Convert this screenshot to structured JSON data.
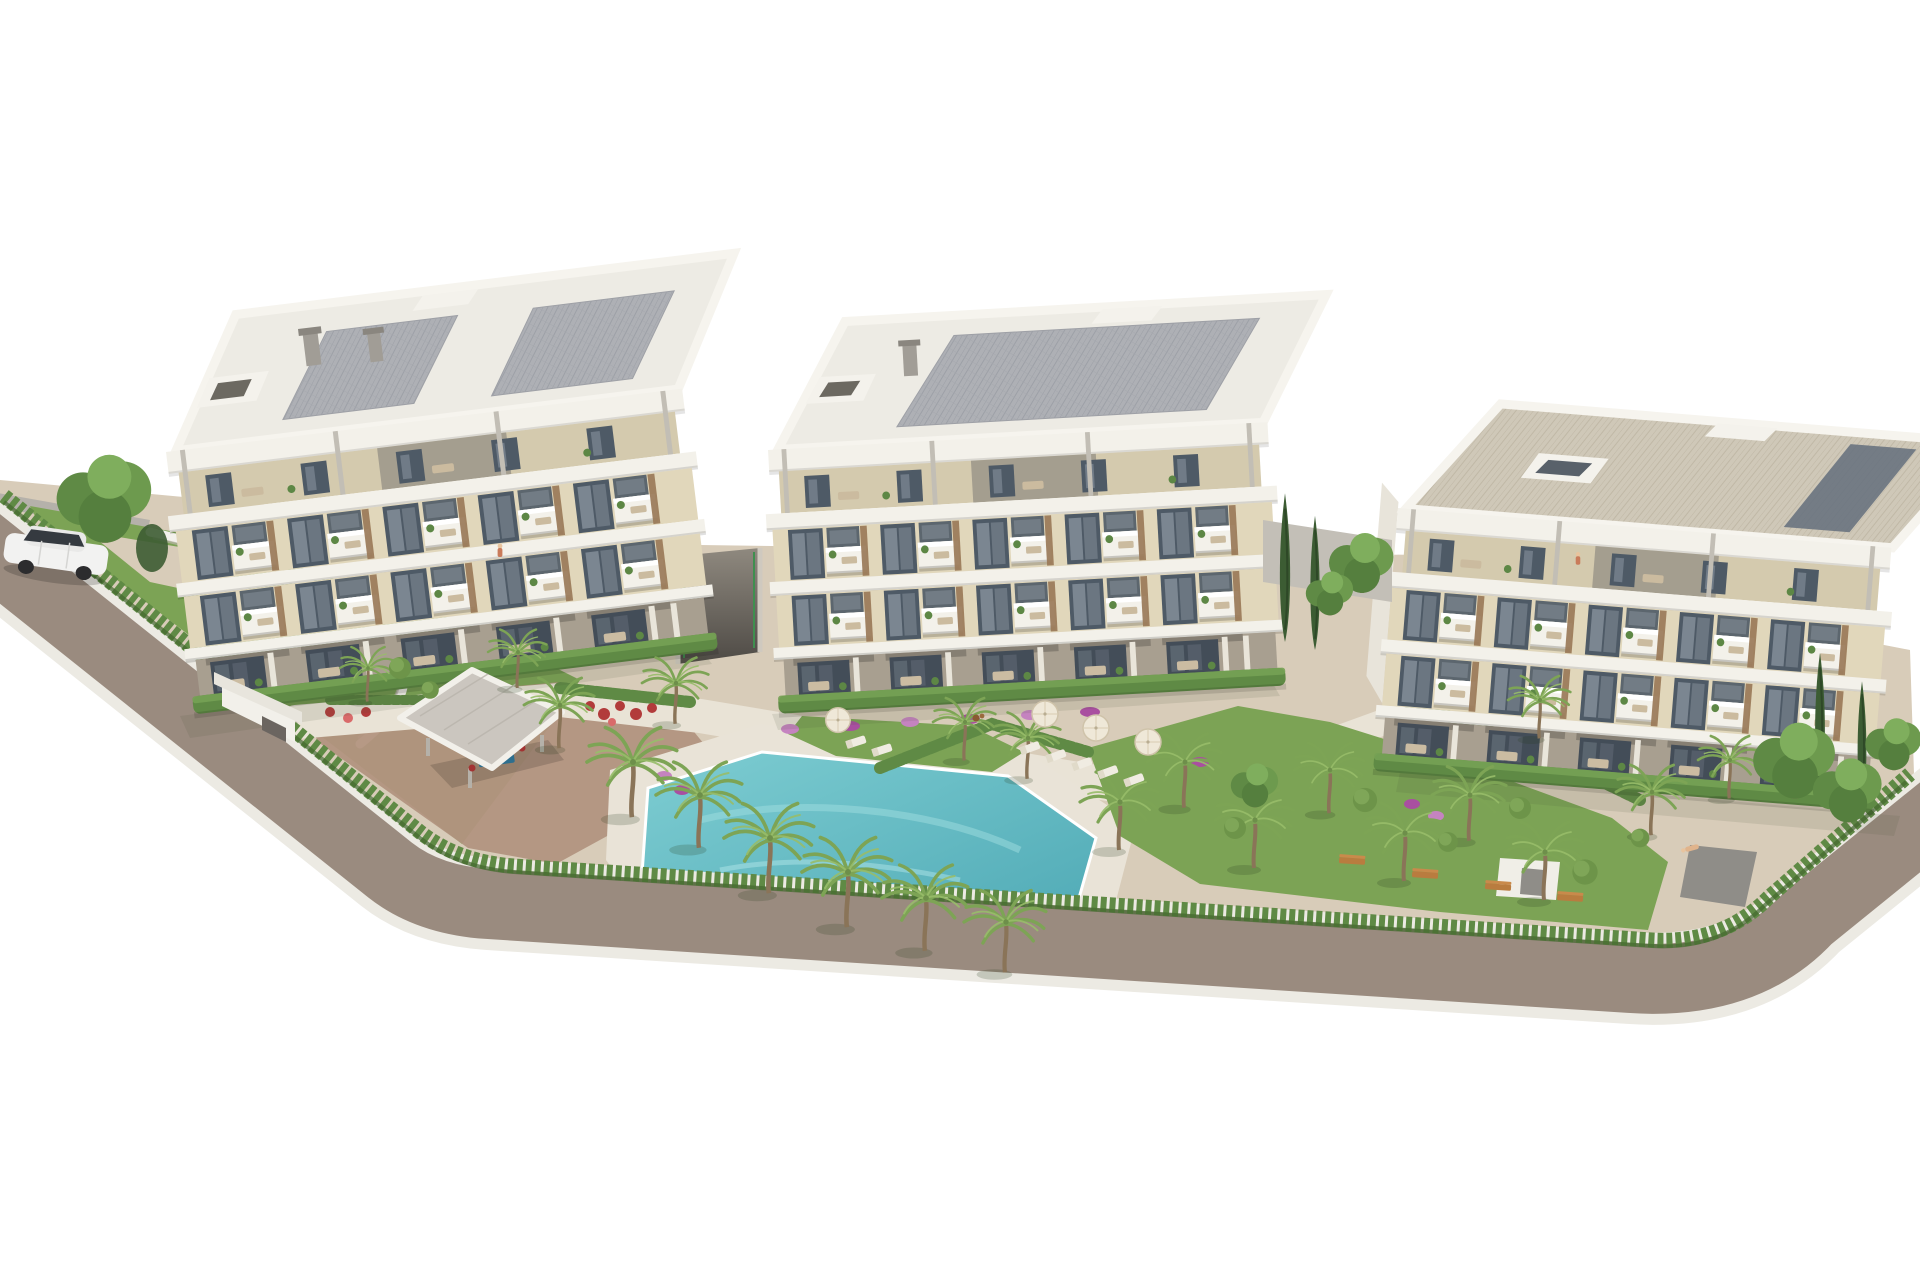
{
  "scene": {
    "alt": "Aerial 3D architectural rendering of a residential complex: three modern cream-and-white apartment buildings with flat solar-panel roofs and plant-filled balconies, communal landscaped gardens with palm trees, hedges, flower beds, a turquoise swimming pool, sun loungers with parasols, a grey-roofed pavilion, an entrance gate, and an L-shaped road with a parked white car, on a plain white background.",
    "elements": {
      "buildings": 3,
      "swimming_pool": 1,
      "pavilion": 1,
      "entrance_gate": 1,
      "parked_cars": 1,
      "parasols": 4,
      "garden_benches": 4
    }
  },
  "colors": {
    "background": "#ffffff",
    "road": "#9a8b7f",
    "curb": "#eceae3",
    "walkway": "#d8ccb9",
    "plaza": "#b29480",
    "path_light": "#e9e3d6",
    "lawn": "#7ca355",
    "lawn_dark": "#6a9347",
    "hedge": "#5f8a45",
    "hedge_dark": "#44682f",
    "pool_water": "#6fc5cb",
    "pool_deep": "#4da8b4",
    "pool_deck": "#e9e3d7",
    "slab_white": "#f3f1ea",
    "roof_deck": "#edebe4",
    "solar_panel": "#aeb0b5",
    "roof_tan": "#cfc8b8",
    "facade_cream": "#e1d7bb",
    "facade_penthouse": "#d4caae",
    "facade_section": "#a49e8f",
    "window_dark": "#4e5a66",
    "glass": "#87919c",
    "wood": "#9a7a58",
    "ground_floor": "#a89f90",
    "pavilion_roof": "#cbc6bf",
    "wall_gray": "#b5b1aa",
    "ramp_dark": "#4e4a45",
    "flower_pink": "#c583c0",
    "flower_magenta": "#a94fa0",
    "flower_red": "#b23b3b",
    "bench_orange": "#b97c3f",
    "palm_green": "#7da455",
    "palm_light": "#98bd6a",
    "trunk_brown": "#8a7458",
    "tree_dark": "#3c5c33",
    "bush_green": "#6d9449",
    "car_white": "#f2f2f1",
    "car_glass": "#353a40"
  }
}
